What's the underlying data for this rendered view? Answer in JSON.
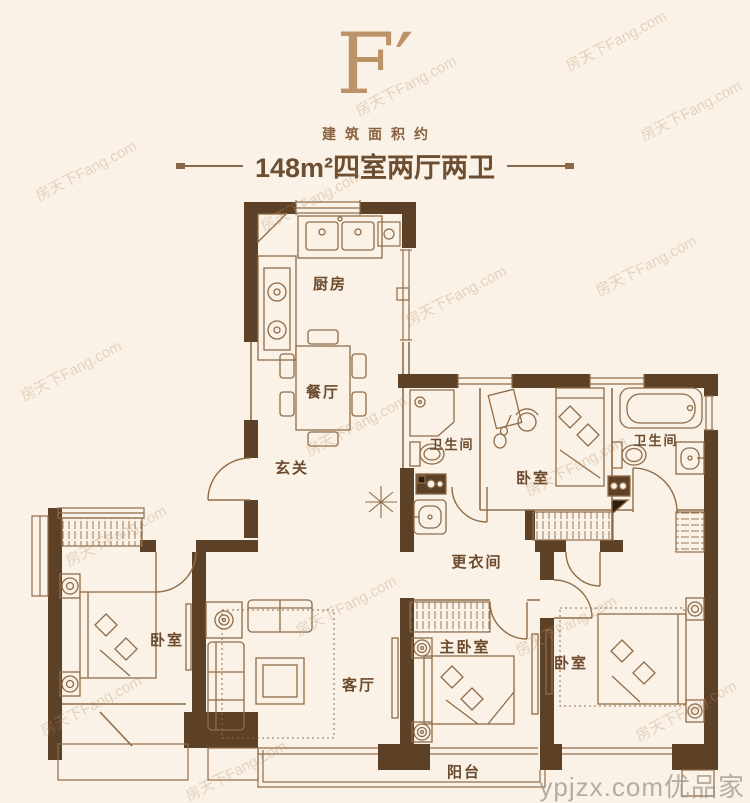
{
  "header": {
    "plan_code": "F′",
    "area_label": "建筑面积约",
    "area_spec": "148m²四室两厅两卫"
  },
  "rooms": {
    "kitchen": "厨房",
    "dining": "餐厅",
    "foyer": "玄关",
    "bath_middle": "卫生间",
    "bath_right": "卫生间",
    "bedroom_top": "卧室",
    "dressing": "更衣间",
    "bedroom_left": "卧室",
    "living": "客厅",
    "master": "主卧室",
    "bedroom_right": "卧室",
    "balcony": "阳台"
  },
  "watermark": {
    "site": "房天下Fang.com",
    "brand": "ypjzx.com优品家"
  },
  "colors": {
    "background": "#faf2e6",
    "wall": "#5d4126",
    "line": "#8f6c49",
    "accent": "#bc9268",
    "label_text": "#6b4a2e"
  }
}
